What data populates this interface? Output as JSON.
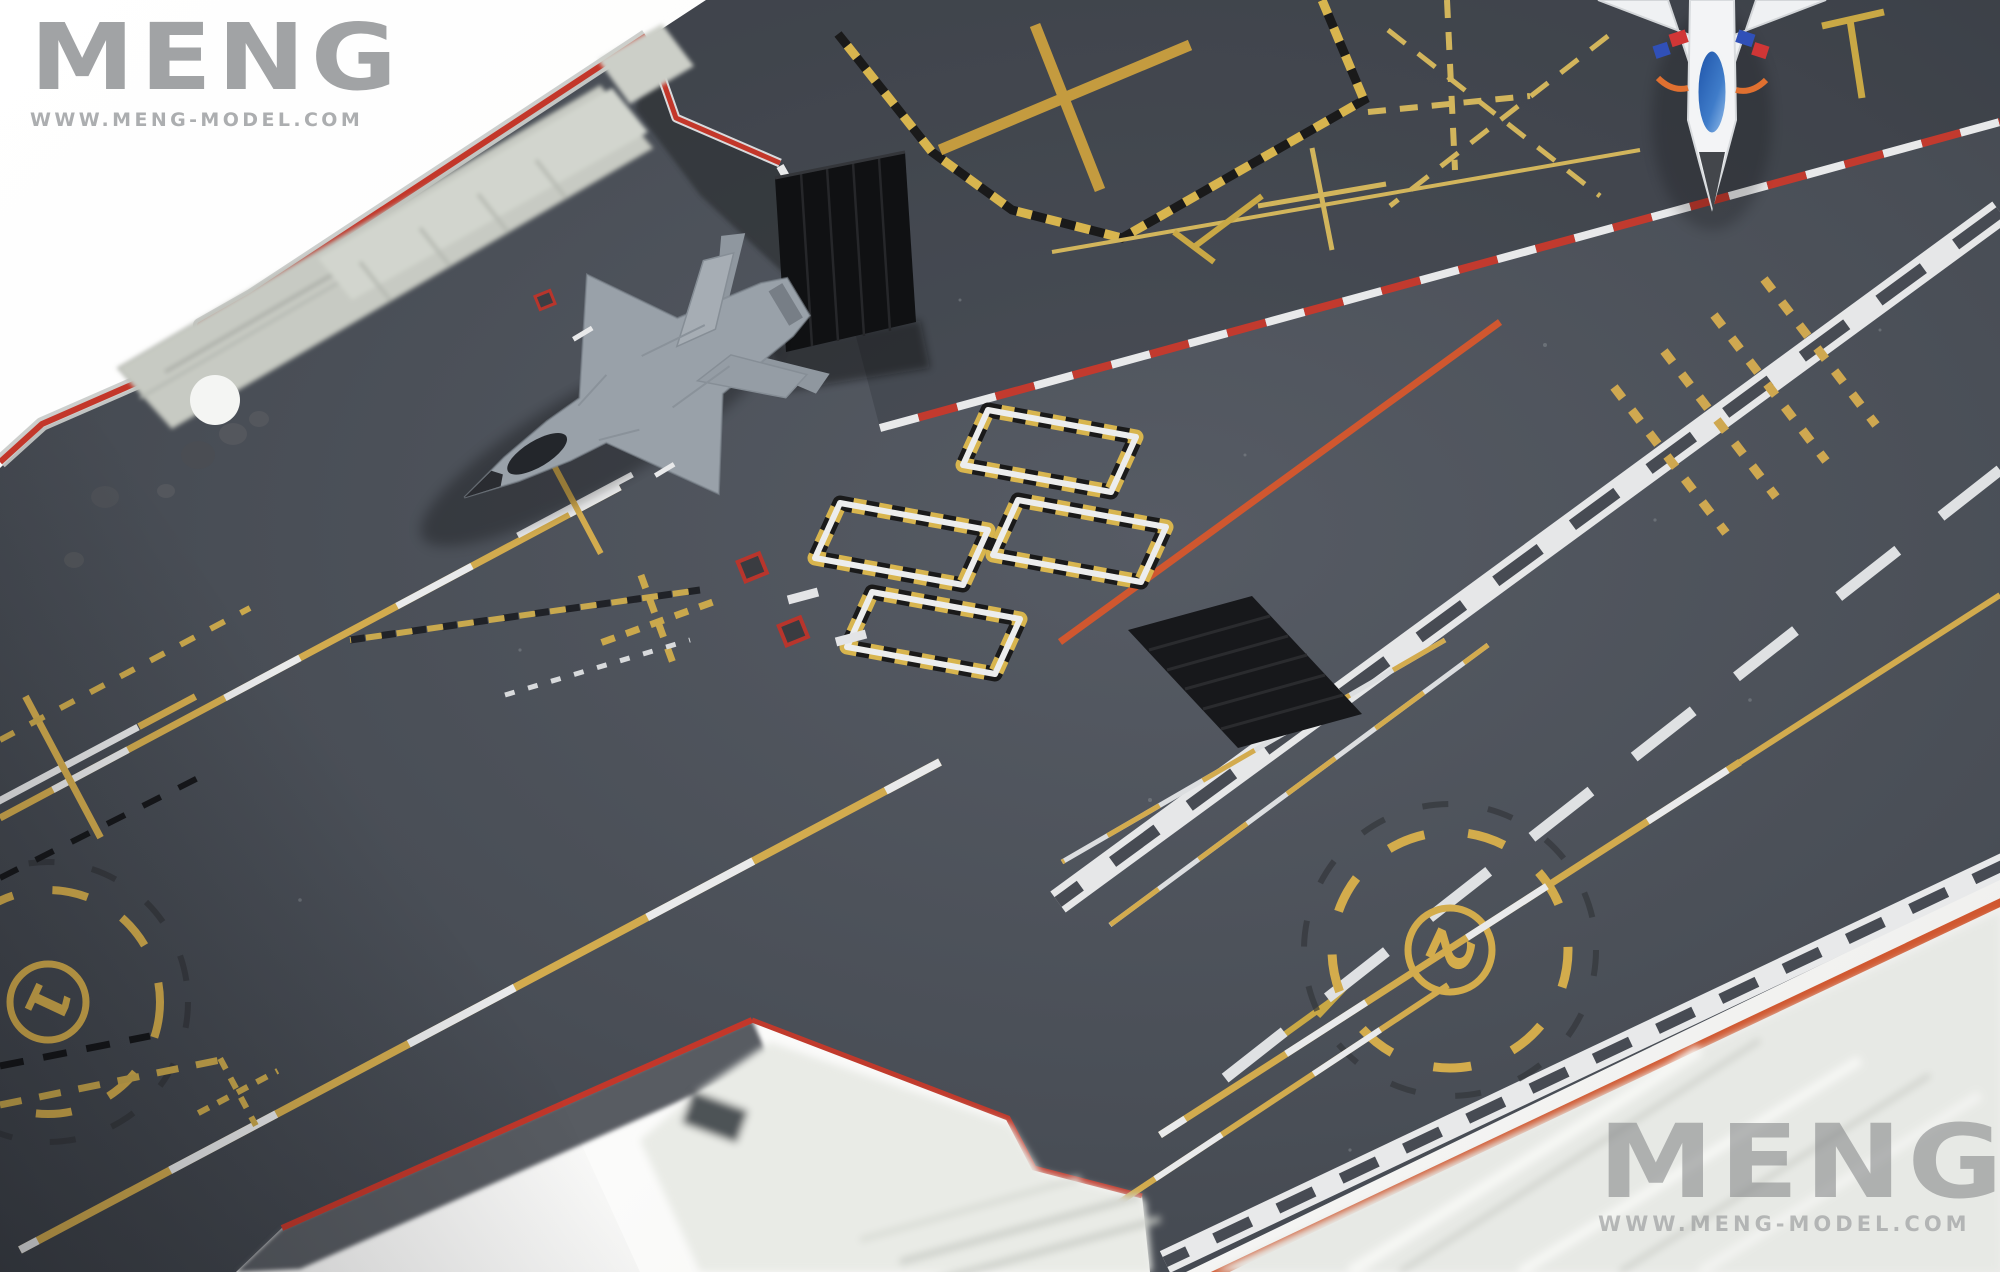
{
  "branding": {
    "logo_text": "MENG",
    "website": "WWW.MENG-MODEL.COM"
  },
  "watermark": {
    "logo_text": "MENG",
    "website": "WWW.MENG-MODEL.COM"
  },
  "deck_labels": {
    "launch_spot_1": "1",
    "launch_spot_2": "2"
  },
  "colors": {
    "background": "#ffffff",
    "deck_gray": "#4a4e55",
    "deck_edge_red": "#c4372b",
    "foul_line_red": "#c23a2e",
    "foul_line_orange": "#d0572f",
    "marking_white": "#e8e9ea",
    "marking_yellow": "#d2ab4e",
    "marking_gold": "#c49b3f",
    "hazard_black": "#1a1a1a",
    "jbd_black": "#141518",
    "hull_light_gray": "#c7cac3",
    "jet_gray": "#99a1a9",
    "jet_white": "#eff1f3",
    "canopy_blue": "#2e6fc0",
    "logo_gray": "#a1a3a5"
  }
}
